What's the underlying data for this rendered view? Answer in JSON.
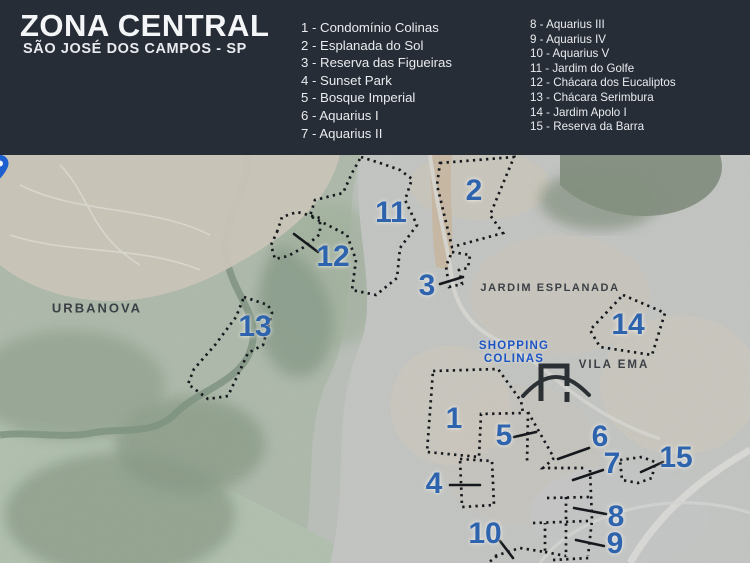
{
  "header": {
    "title": "ZONA CENTRAL",
    "subtitle": "SÃO JOSÉ DOS CAMPOS - SP",
    "legend_col1": [
      "1 - Condomínio Colinas",
      "2 - Esplanada do Sol",
      "3 - Reserva das Figueiras",
      "4 - Sunset Park",
      "5 - Bosque Imperial",
      "6 - Aquarius I",
      "7 - Aquarius II"
    ],
    "legend_col2": [
      "8 - Aquarius III",
      "9 - Aquarius IV",
      "10 - Aquarius V",
      "11 - Jardim do Golfe",
      "12 - Chácara dos Eucaliptos",
      "13 - Chácara Serimbura",
      "14 - Jardim Apolo I",
      "15 - Reserva da Barra"
    ]
  },
  "map": {
    "area_labels": {
      "urbanova": "URBANOVA",
      "jardim_esplanada": "JARDIM ESPLANADA",
      "vila_ema": "VILA EMA"
    },
    "poi_shopping": {
      "line1": "SHOPPING",
      "line2": "COLINAS"
    },
    "markers": [
      {
        "number": "1"
      },
      {
        "number": "2"
      },
      {
        "number": "3"
      },
      {
        "number": "4"
      },
      {
        "number": "5"
      },
      {
        "number": "6"
      },
      {
        "number": "7"
      },
      {
        "number": "8"
      },
      {
        "number": "9"
      },
      {
        "number": "10"
      },
      {
        "number": "11"
      },
      {
        "number": "12"
      },
      {
        "number": "13"
      },
      {
        "number": "14"
      },
      {
        "number": "15"
      }
    ],
    "colors": {
      "header_bg": "#272d37",
      "marker_blue": "#2e63ad",
      "poi_blue": "#1b55c4",
      "outline_black": "#15181c"
    }
  }
}
